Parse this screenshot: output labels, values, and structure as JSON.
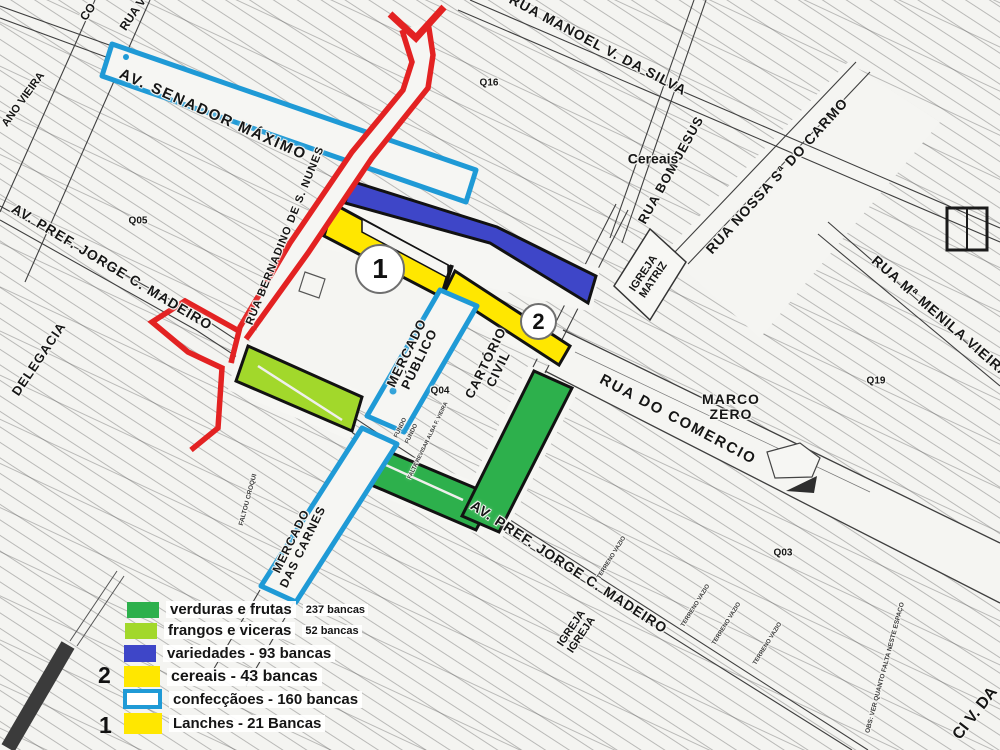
{
  "street_labels": {
    "av_senador_maximo": "AV. SENADOR MÁXIMO",
    "rua_manoel_v_da_silva": "RUA MANOEL V. DA SILVA",
    "rua_bom_jesus": "RUA BOM JESUS",
    "rua_nossa_sa_do_carmo": "RUA NOSSA Sª DO CARMO",
    "rua_ma_menila_vieira": "RUA Mª MENILA VIEIRA",
    "av_pref_jorge_c_madeiro_1": "AV. PREF. JORGE C. MADEIRO",
    "av_pref_jorge_c_madeiro_2": "AV. PREF. JORGE C. MADEIRO",
    "rua_bernadino_de_s_nunes": "RUA BERNADINO DE S. NUNES",
    "rua_do_comercio": "RUA DO COMERCIO",
    "rua_ci_v_da": "CI V. DA",
    "rua_v_partial": "RUA V",
    "co_partial": "CO",
    "ano_vieira_partial": "ANO VIEIRA"
  },
  "place_labels": {
    "delegacia": "DELEGACIA",
    "mercado_publico_1": "MERCADO",
    "mercado_publico_2": "PÚBLICO",
    "cartorio_civil_1": "CARTÓRIO",
    "cartorio_civil_2": "CIVIL",
    "mercado_das_carnes_1": "MERCADO",
    "mercado_das_carnes_2": "DAS CARNES",
    "igreja_matriz_1": "IGREJA",
    "igreja_matriz_2": "MATRIZ",
    "igreja_igreja_1": "IGREJA",
    "igreja_igreja_2": "IGREJA",
    "marco_zero_1": "MARCO",
    "marco_zero_2": "ZERO",
    "cereais": "Cereais"
  },
  "block_labels": {
    "q05": "Q05",
    "q16": "Q16",
    "q04": "Q04",
    "q19": "Q19",
    "q03": "Q03"
  },
  "markers": {
    "circle_1": "1",
    "circle_2": "2"
  },
  "notes": {
    "terreno_vazio": "TERRENO VAZIO",
    "obs_espaco": "OBS: VER QUANTO FALTA NESTE ESPAÇO",
    "faltou_croqui": "FALTOU CROQUI",
    "fundo": "FUNDO",
    "falta_revisar": "FALTA REVISAR ALBA F. VIEIRA"
  },
  "legend": {
    "rows": [
      {
        "marker": "",
        "color": "#2db04c",
        "border": "",
        "label": "verduras e frutas",
        "count": "237 bancas"
      },
      {
        "marker": "",
        "color": "#a2d82b",
        "border": "",
        "label": "frangos e viceras",
        "count": "52 bancas"
      },
      {
        "marker": "",
        "color": "#3e46c8",
        "border": "",
        "label": "variedades -  93 bancas",
        "count": ""
      },
      {
        "marker": "2",
        "color": "#ffe700",
        "border": "",
        "label": "cereais - 43 bancas",
        "count": ""
      },
      {
        "marker": "",
        "color": "#ffffff",
        "border": "#1f9ad6",
        "label": "confecçãoes - 160 bancas",
        "count": ""
      },
      {
        "marker": "1",
        "color": "#ffe700",
        "border": "",
        "label": "Lanches  - 21 Bancas",
        "count": ""
      }
    ]
  },
  "zone_colors": {
    "verduras": "#2db04c",
    "frangos": "#a2d82b",
    "variedades": "#3e46c8",
    "cereais_lanches": "#ffe700",
    "confeccoes_outline": "#1f9ad6",
    "route": "#e32222"
  }
}
